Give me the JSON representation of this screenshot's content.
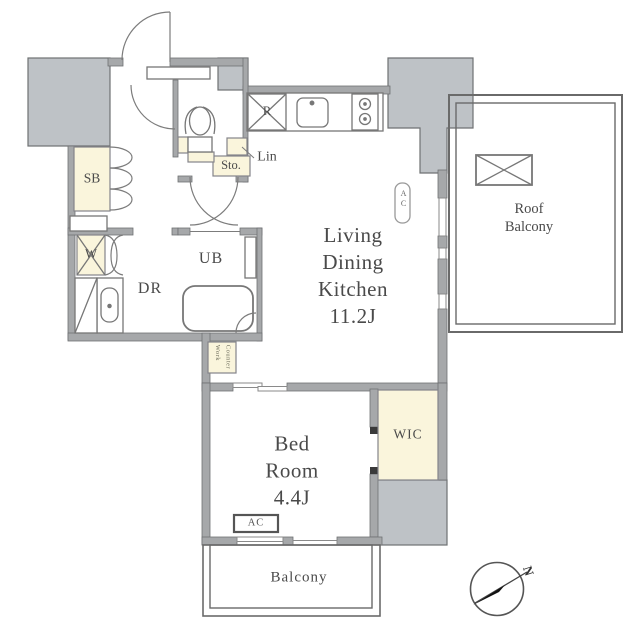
{
  "labels": {
    "ldk1": "Living",
    "ldk2": "Dining",
    "ldk3": "Kitchen",
    "ldk4": "11.2J",
    "bed1": "Bed",
    "bed2": "Room",
    "bed3": "4.4J",
    "roof1": "Roof",
    "roof2": "Balcony",
    "balcony": "Balcony",
    "dr": "DR",
    "ub": "UB",
    "sb": "SB",
    "w": "W",
    "sto": "Sto.",
    "lin": "Lin",
    "r": "R",
    "wic": "WIC",
    "ac_living": "AC",
    "ac_bed": "AC",
    "work1": "Work",
    "work2": "Counter",
    "compass_n": "N"
  },
  "colors": {
    "wall": "#a6a8aa",
    "zone": "#bec2c6",
    "cream": "#faf5dc",
    "line": "#777777",
    "text": "#4a4a4a"
  }
}
